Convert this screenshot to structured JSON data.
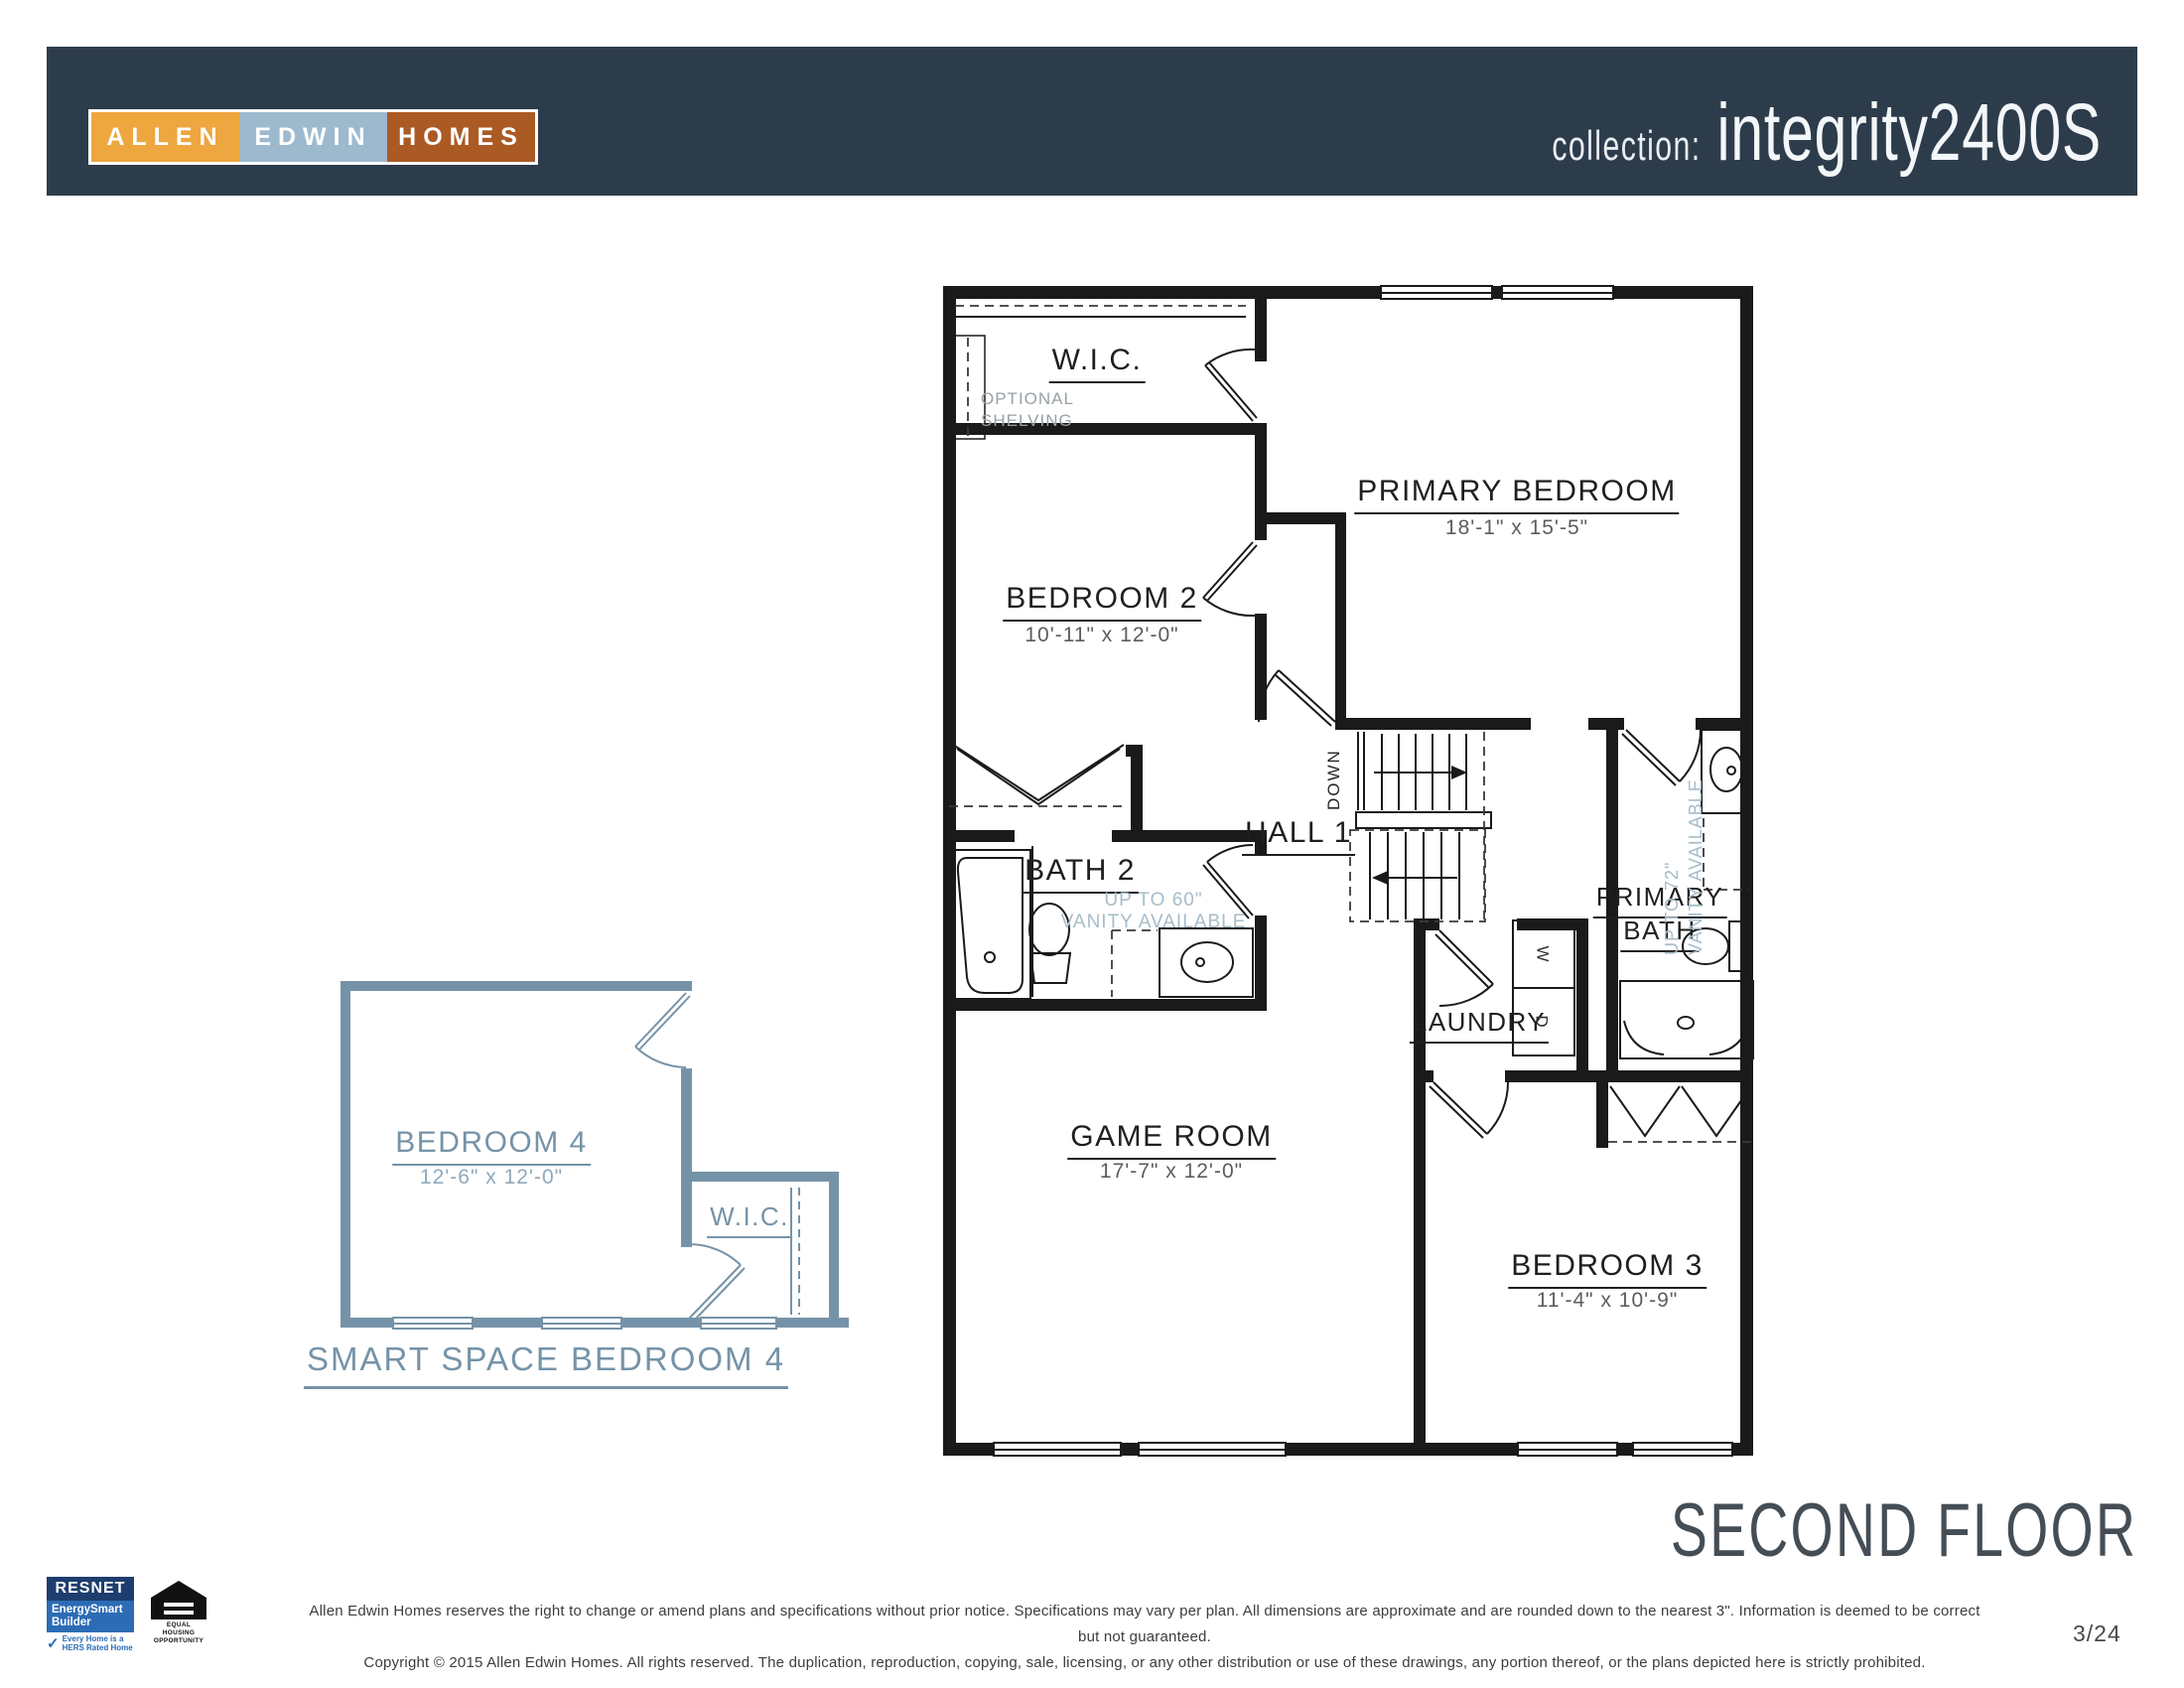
{
  "header": {
    "collection_label": "collection:",
    "collection_value": "integrity2400S",
    "logo": {
      "part1": "ALLEN",
      "part2": "EDWIN",
      "part3": "HOMES"
    }
  },
  "plan": {
    "wic": {
      "name": "W.I.C."
    },
    "optional_shelving": {
      "line1": "OPTIONAL",
      "line2": "SHELVING"
    },
    "primary_bedroom": {
      "name": "PRIMARY BEDROOM",
      "dims": "18'-1\" x 15'-5\""
    },
    "bedroom2": {
      "name": "BEDROOM 2",
      "dims": "10'-11\" x 12'-0\""
    },
    "bath2": {
      "name": "BATH 2",
      "note1": "UP TO 60\"",
      "note2": "VANITY AVAILABLE"
    },
    "hall1": {
      "name": "HALL 1"
    },
    "stairs": {
      "down": "DOWN"
    },
    "primary_bath": {
      "name1": "PRIMARY",
      "name2": "BATH",
      "note1": "UP TO 72\"",
      "note2": "VANITY AVAILABLE"
    },
    "laundry": {
      "name": "LAUNDRY",
      "washer": "W",
      "dryer": "D"
    },
    "game_room": {
      "name": "GAME ROOM",
      "dims": "17'-7\" x 12'-0\""
    },
    "bedroom3": {
      "name": "BEDROOM 3",
      "dims": "11'-4\" x 10'-9\""
    }
  },
  "smart_space": {
    "bedroom4": {
      "name": "BEDROOM 4",
      "dims": "12'-6\" x 12'-0\""
    },
    "wic": {
      "name": "W.I.C."
    },
    "caption": "SMART SPACE BEDROOM 4"
  },
  "floor_title": "SECOND FLOOR",
  "footer": {
    "disclaimer_line1": "Allen Edwin Homes reserves the right to change or amend plans and specifications without prior notice. Specifications may vary per plan. All dimensions are approximate and are rounded down to the nearest 3\". Information is deemed to be correct but not guaranteed.",
    "disclaimer_line2": "Copyright © 2015 Allen Edwin Homes. All rights reserved. The duplication, reproduction, copying, sale, licensing, or any other distribution or use of these drawings, any portion thereof, or the plans depicted here is strictly prohibited.",
    "page_number": "3/24",
    "resnet": {
      "title": "RESNET",
      "sub1": "EnergySmart",
      "sub2": "Builder",
      "check": "✓",
      "tag1": "Every Home is a",
      "tag2": "HERS Rated Home"
    },
    "equal_housing": {
      "line1": "EQUAL HOUSING",
      "line2": "OPPORTUNITY"
    }
  },
  "colors": {
    "header_bg": "#2d3c4b",
    "allen": "#eea63f",
    "edwin": "#9db9ce",
    "homes": "#ab5a24",
    "wall": "#1a1a1a",
    "smart_plan": "#7593a8",
    "note": "#a7bcc9",
    "title_gray": "#454d55"
  }
}
